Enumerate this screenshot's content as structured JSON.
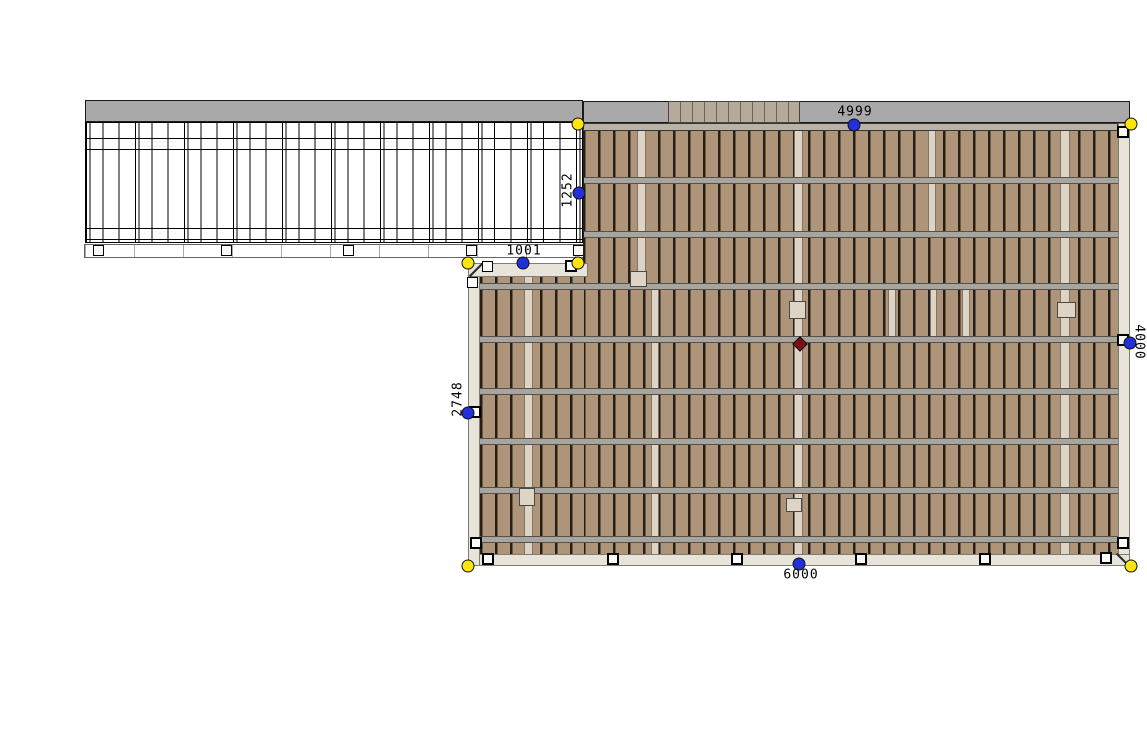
{
  "app": {
    "view_name": "deck-framing-plan"
  },
  "dimension_labels": {
    "top": "4999",
    "upper_left": "1252",
    "notch": "1001",
    "lower_left": "2748",
    "right": "4000",
    "bottom": "6000"
  },
  "markers": {
    "corner_handle_count": 6,
    "midpoint_handle_count": 6,
    "corner_handle_color": "#ffe60a",
    "midpoint_handle_color": "#2230d9",
    "center_point_color": "#7c1212"
  },
  "colors": {
    "deck_board": "#ae9478",
    "board_gap": "#261f17",
    "light_board": "#ddd4c5",
    "joist_band": "#a8a49e",
    "fascia": "#a9a9a9",
    "stair_tread": "#b8aa99",
    "frame": "#e9e4da",
    "canvas_bg": "#ffffff"
  }
}
